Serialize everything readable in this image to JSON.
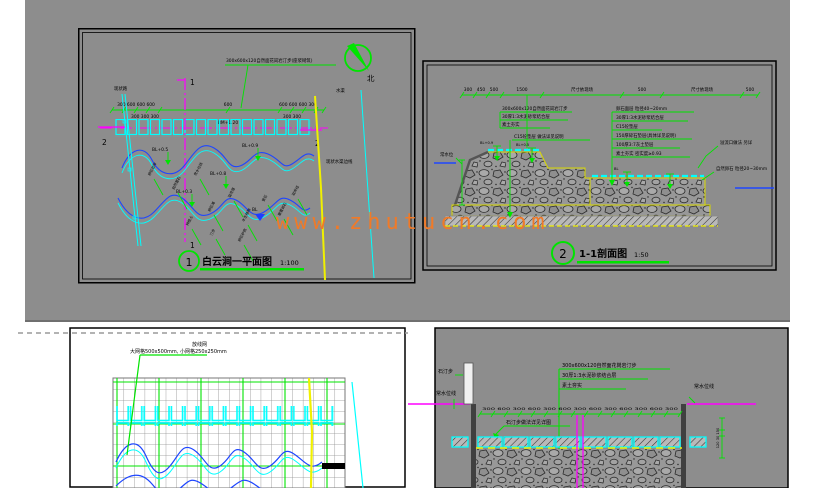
{
  "watermark": "www.zhutucn.com",
  "plan": {
    "number": "1",
    "title": "白云涧一平面图",
    "scale": "1:100",
    "north_label": "北",
    "note": "300x600x120自然面花岗岩汀步(座浆砌筑)",
    "bm_label": "BM+1.20",
    "dim_left": "300 600 600 600",
    "dim_mid": "600",
    "dim_right": "600 600 600 300",
    "dim_sub_left": "300 300 300",
    "dim_sub_right": "300 300",
    "marker_1": "1",
    "marker_2": "2",
    "label_left_top": "现状路",
    "label_yellow": "水渠",
    "label_right": "现状水渠边线",
    "elev_1": "BL+0.5",
    "elev_2": "BL+0.9",
    "elev_3": "BL+0.8",
    "elev_4": "BL+0.3",
    "elev_5": "BL",
    "angled_labels": [
      "卵石驳岸",
      "自然置石",
      "常水位线",
      "卵石滩",
      "溢流堰",
      "水生植物",
      "景石",
      "散置卵石",
      "驳岸线",
      "种植土",
      "汀步",
      "卵石护底"
    ]
  },
  "section": {
    "number": "2",
    "title": "1-1剖面图",
    "scale": "1:50",
    "dims": [
      "300",
      "450",
      "500",
      "1500",
      "尺寸依现场",
      "500",
      "尺寸依现场",
      "500"
    ],
    "stack_left": [
      "300x600x120自然面花岗岩汀步",
      "30厚1:3水泥砂浆结合层",
      "素土夯实"
    ],
    "note_c15": "C15砼垫层 做法详见说明",
    "stack_right": [
      "卵石面层 粒径40~20mm",
      "30厚1:3水泥砂浆结合层",
      "C15砼垫层",
      "150厚碎石垫层(具体详见说明)",
      "100厚3:7灰土垫层",
      "素土夯实 密实度≥0.93"
    ],
    "label_waterline": "常水位",
    "label_right_top": "溢流口做法 另详",
    "label_right_bottom": "自然卵石 粒径20~30mm",
    "elev_a": "BL+0.9",
    "elev_b": "BL+0.5",
    "elev_c": "BL"
  },
  "layout_plan": {
    "note_title": "放线网",
    "note_body": "大网格500x500mm, 小网格250x250mm"
  },
  "detail_section": {
    "stack_top": [
      "300x600x120自然面花岗岩汀步",
      "30厚1:3水泥砂浆结合层",
      "素土夯实"
    ],
    "note_mid": "石汀步做法详见详图",
    "label_left_top": "石汀步",
    "label_left_bottom": "常水位线",
    "label_right": "常水位线",
    "dims_run": "300 600 300 600 300 600 300 600 300 600 300 600 300",
    "dims_vert": "120 30 150"
  }
}
